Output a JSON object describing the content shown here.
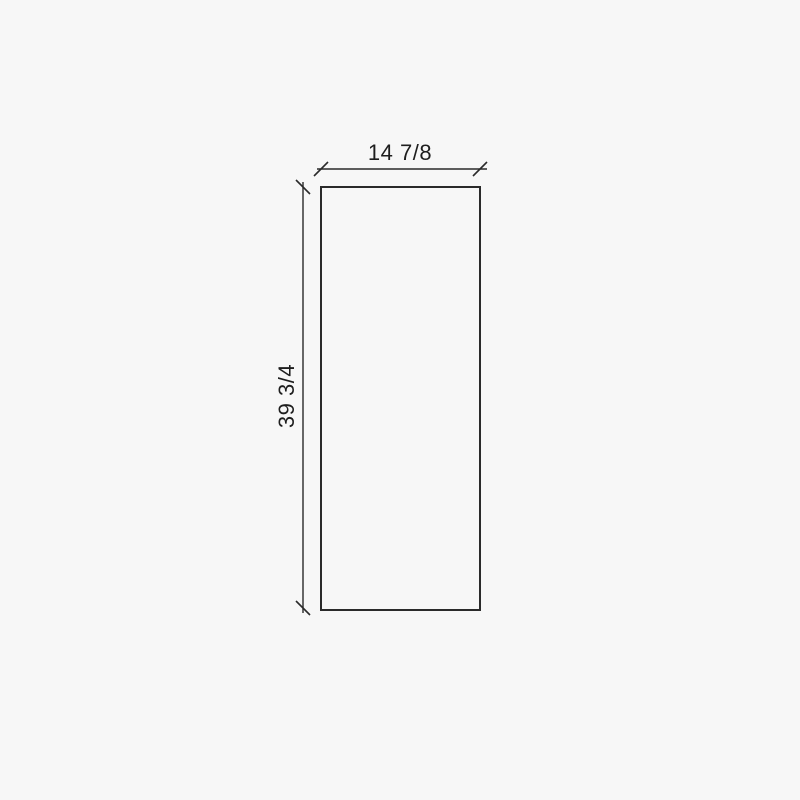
{
  "page": {
    "background_color": "#f7f7f7"
  },
  "drawing": {
    "line_color": "#2a2a2a",
    "panel": {
      "fill": "none"
    },
    "dimensions": {
      "width": {
        "label": "14 7/8"
      },
      "height": {
        "label": "39 3/4"
      }
    }
  }
}
